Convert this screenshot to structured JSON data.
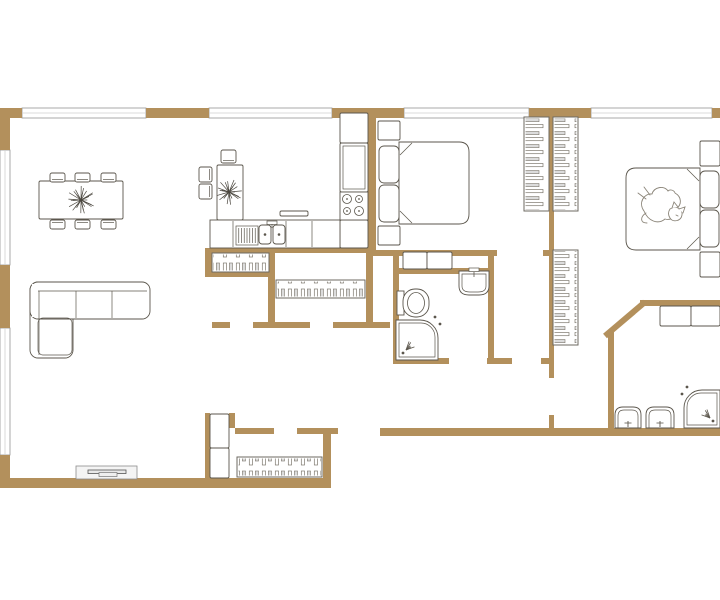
{
  "meta": {
    "description": "apartment floor plan, top view, no text labels"
  },
  "colors": {
    "wall": "#b3905c",
    "outline": "#5b564c",
    "thin": "#8a8a8a",
    "arc": "#c6c6c6",
    "leaf": "#a3a3a3",
    "leafEdge": "#6f6f6f",
    "dark": "#262626",
    "hatchLine": "#7d786e",
    "hatchFill": "#dcdcdc",
    "catLine": "#8a8478",
    "paw": "#8f8f8f",
    "window": "#949494",
    "screenFill": "#e8e8e8"
  },
  "plan": {
    "walls_h": [
      {
        "x1": 0,
        "x2": 22,
        "y": 108,
        "h": 10
      },
      {
        "x1": 146,
        "x2": 209,
        "y": 108,
        "h": 10
      },
      {
        "x1": 332,
        "x2": 404,
        "y": 108,
        "h": 10
      },
      {
        "x1": 529,
        "x2": 591,
        "y": 108,
        "h": 10
      },
      {
        "x1": 712,
        "x2": 720,
        "y": 108,
        "h": 10
      },
      {
        "x1": 372,
        "x2": 497,
        "y": 250,
        "h": 6
      },
      {
        "x1": 543,
        "x2": 554,
        "y": 250,
        "h": 6
      },
      {
        "x1": 205,
        "x2": 372,
        "y": 248,
        "h": 5
      },
      {
        "x1": 205,
        "x2": 275,
        "y": 272,
        "h": 5
      },
      {
        "x1": 212,
        "x2": 230,
        "y": 322,
        "h": 6
      },
      {
        "x1": 253,
        "x2": 310,
        "y": 322,
        "h": 6
      },
      {
        "x1": 333,
        "x2": 390,
        "y": 322,
        "h": 6
      },
      {
        "x1": 393,
        "x2": 494,
        "y": 268,
        "h": 6
      },
      {
        "x1": 393,
        "x2": 449,
        "y": 358,
        "h": 6
      },
      {
        "x1": 487,
        "x2": 512,
        "y": 358,
        "h": 6
      },
      {
        "x1": 541,
        "x2": 554,
        "y": 358,
        "h": 6
      },
      {
        "x1": 640,
        "x2": 720,
        "y": 300,
        "h": 6
      },
      {
        "x1": 235,
        "x2": 274,
        "y": 428,
        "h": 6
      },
      {
        "x1": 297,
        "x2": 338,
        "y": 428,
        "h": 6
      },
      {
        "x1": 380,
        "x2": 720,
        "y": 428,
        "h": 8
      },
      {
        "x1": 0,
        "x2": 331,
        "y": 478,
        "h": 10
      }
    ],
    "walls_v": [
      {
        "x": 0,
        "y1": 108,
        "y2": 150,
        "w": 10
      },
      {
        "x": 0,
        "y1": 265,
        "y2": 328,
        "w": 10
      },
      {
        "x": 0,
        "y1": 455,
        "y2": 488,
        "w": 10
      },
      {
        "x": 368,
        "y1": 118,
        "y2": 254,
        "w": 8
      },
      {
        "x": 366,
        "y1": 248,
        "y2": 328,
        "w": 7
      },
      {
        "x": 549,
        "y1": 118,
        "y2": 378,
        "w": 5
      },
      {
        "x": 549,
        "y1": 415,
        "y2": 428,
        "w": 5
      },
      {
        "x": 608,
        "y1": 332,
        "y2": 428,
        "w": 6
      },
      {
        "x": 205,
        "y1": 248,
        "y2": 277,
        "w": 7
      },
      {
        "x": 268,
        "y1": 248,
        "y2": 328,
        "w": 7
      },
      {
        "x": 393,
        "y1": 250,
        "y2": 358,
        "w": 6
      },
      {
        "x": 488,
        "y1": 250,
        "y2": 358,
        "w": 6
      },
      {
        "x": 205,
        "y1": 413,
        "y2": 488,
        "w": 5
      },
      {
        "x": 229,
        "y1": 413,
        "y2": 428,
        "w": 6
      },
      {
        "x": 323,
        "y1": 428,
        "y2": 488,
        "w": 8
      }
    ],
    "walls_d": [
      {
        "x1": 605,
        "y1": 336,
        "x2": 645,
        "y2": 302,
        "w": 6
      }
    ],
    "windows": [
      {
        "x": 22,
        "y": 108,
        "w": 124,
        "h": 10,
        "o": "h"
      },
      {
        "x": 209,
        "y": 108,
        "w": 123,
        "h": 10,
        "o": "h"
      },
      {
        "x": 404,
        "y": 108,
        "w": 125,
        "h": 10,
        "o": "h"
      },
      {
        "x": 591,
        "y": 108,
        "w": 121,
        "h": 10,
        "o": "h"
      },
      {
        "x": 0,
        "y": 150,
        "w": 10,
        "h": 115,
        "o": "v"
      },
      {
        "x": 0,
        "y": 328,
        "w": 10,
        "h": 127,
        "o": "v"
      }
    ],
    "wardrobes": [
      {
        "n": "wardrobe-bedroom1",
        "x": 524,
        "y": 117,
        "w": 25,
        "h": 94,
        "o": "v"
      },
      {
        "n": "wardrobe-bedroom2",
        "x": 553,
        "y": 117,
        "w": 25,
        "h": 94,
        "o": "v"
      },
      {
        "n": "wardrobe-bedroom2-lower",
        "x": 553,
        "y": 250,
        "w": 25,
        "h": 95,
        "o": "v"
      },
      {
        "n": "closet-kitchen-left",
        "x": 212,
        "y": 253,
        "w": 57,
        "h": 19,
        "o": "h"
      },
      {
        "n": "closet-kitchen-right",
        "x": 276,
        "y": 280,
        "w": 89,
        "h": 18,
        "o": "h"
      },
      {
        "n": "entry-radiator",
        "x": 237,
        "y": 457,
        "w": 85,
        "h": 20,
        "o": "h"
      }
    ],
    "cabinets": [
      {
        "n": "kitchen-tall-cabinet",
        "x": 340,
        "y": 113,
        "w": 28,
        "h": 30
      },
      {
        "n": "kitchen-cabinet",
        "x": 340,
        "y": 143,
        "w": 28,
        "h": 49,
        "inner": true
      },
      {
        "n": "kitchen-counter-end",
        "x": 340,
        "y": 220,
        "w": 28,
        "h": 28
      },
      {
        "n": "kitchen-shelf",
        "x": 280,
        "y": 211,
        "w": 28,
        "h": 5
      },
      {
        "n": "laundry-cabinet",
        "x": 403,
        "y": 252,
        "w": 24,
        "h": 17
      },
      {
        "n": "laundry-cabinet",
        "x": 427,
        "y": 252,
        "w": 25,
        "h": 17
      },
      {
        "n": "bath-counter",
        "x": 660,
        "y": 306,
        "w": 31,
        "h": 20
      },
      {
        "n": "bath-counter",
        "x": 691,
        "y": 306,
        "w": 29,
        "h": 20
      },
      {
        "n": "entry-cabinet",
        "x": 210,
        "y": 414,
        "w": 19,
        "h": 34
      },
      {
        "n": "entry-cabinet",
        "x": 210,
        "y": 448,
        "w": 19,
        "h": 30
      },
      {
        "n": "nightstand",
        "x": 378,
        "y": 121,
        "w": 22,
        "h": 19
      },
      {
        "n": "nightstand",
        "x": 378,
        "y": 226,
        "w": 22,
        "h": 19
      },
      {
        "n": "nightstand",
        "x": 700,
        "y": 141,
        "w": 20,
        "h": 25
      },
      {
        "n": "nightstand",
        "x": 700,
        "y": 252,
        "w": 20,
        "h": 25
      },
      {
        "n": "dining-table",
        "x": 39,
        "y": 181,
        "w": 84,
        "h": 38
      },
      {
        "n": "bistro-table",
        "x": 217,
        "y": 165,
        "w": 26,
        "h": 55
      }
    ],
    "counter": {
      "x": 210,
      "y": 220,
      "w": 130,
      "h": 28,
      "dividers": [
        233,
        286,
        312
      ]
    },
    "dishrack": {
      "x": 236,
      "y": 226,
      "w": 22,
      "h": 19,
      "lines": 7
    },
    "kitchen_sink": {
      "x": 259,
      "y": 225,
      "bw": 12,
      "bh": 19,
      "gap": 2
    },
    "stove": {
      "x": 340,
      "y": 192,
      "w": 28,
      "h": 28
    },
    "chairs": [
      {
        "n": "dining-chair",
        "x": 50,
        "y": 173,
        "w": 15,
        "h": 9,
        "s": "up"
      },
      {
        "n": "dining-chair",
        "x": 75,
        "y": 173,
        "w": 15,
        "h": 9,
        "s": "up"
      },
      {
        "n": "dining-chair",
        "x": 101,
        "y": 173,
        "w": 15,
        "h": 9,
        "s": "up"
      },
      {
        "n": "dining-chair",
        "x": 50,
        "y": 220,
        "w": 15,
        "h": 9,
        "s": "down"
      },
      {
        "n": "dining-chair",
        "x": 75,
        "y": 220,
        "w": 15,
        "h": 9,
        "s": "down"
      },
      {
        "n": "dining-chair",
        "x": 101,
        "y": 220,
        "w": 15,
        "h": 9,
        "s": "down"
      },
      {
        "n": "bistro-chair",
        "x": 199,
        "y": 167,
        "w": 13,
        "h": 15,
        "s": "left"
      },
      {
        "n": "bistro-chair",
        "x": 199,
        "y": 184,
        "w": 13,
        "h": 15,
        "s": "left"
      },
      {
        "n": "bistro-chair",
        "x": 221,
        "y": 150,
        "w": 15,
        "h": 13,
        "s": "up"
      }
    ],
    "plants": [
      {
        "n": "plant-dining",
        "cx": 81,
        "cy": 200,
        "r": 14,
        "spokes": 26
      },
      {
        "n": "plant-bistro",
        "cx": 229,
        "cy": 192,
        "r": 13,
        "spokes": 24
      }
    ],
    "sofa": {
      "x": 30,
      "y": 282,
      "wide": 120,
      "deep": 37,
      "chaiseW": 43,
      "chaiseH": 76
    },
    "tv": {
      "x": 76,
      "y": 466,
      "w": 61,
      "h": 13
    },
    "beds": [
      {
        "n": "bed-bedroom1",
        "x": 399,
        "y": 142,
        "w": 70,
        "h": 82,
        "side": "left",
        "pillows": [
          [
            379,
            146,
            20,
            37
          ],
          [
            379,
            185,
            20,
            37
          ]
        ]
      },
      {
        "n": "bed-bedroom2",
        "x": 626,
        "y": 168,
        "w": 74,
        "h": 82,
        "side": "right",
        "pillows": [
          [
            700,
            171,
            19,
            37
          ],
          [
            700,
            210,
            19,
            37
          ]
        ]
      }
    ],
    "cat": {
      "cx": 660,
      "cy": 207
    },
    "toilet": {
      "x": 397,
      "y": 289,
      "w": 32,
      "h": 28
    },
    "sinks": [
      {
        "n": "bathroom1-sink",
        "x": 459,
        "y": 271,
        "w": 30,
        "h": 24,
        "dir": "down"
      },
      {
        "n": "bathroom2-sink",
        "x": 615,
        "y": 407,
        "w": 26,
        "h": 21,
        "dir": "up"
      },
      {
        "n": "bathroom2-sink",
        "x": 646,
        "y": 407,
        "w": 28,
        "h": 21,
        "dir": "up"
      }
    ],
    "showers": [
      {
        "n": "shower-bathroom1",
        "x": 396,
        "y": 320,
        "w": 42,
        "h": 40,
        "corner": "ne",
        "sparkle": "sw"
      },
      {
        "n": "shower-bathroom2",
        "x": 684,
        "y": 390,
        "w": 36,
        "h": 38,
        "corner": "nw",
        "sparkle": "se"
      }
    ],
    "bathtub": {
      "x": 692,
      "y": 340,
      "w": 46,
      "h": 24
    },
    "doors": [
      {
        "n": "entry-door",
        "leaf": [
          373,
          388,
          4.5,
          40
        ],
        "arc": "M377,388 A40,40 0 0 0 337,428",
        "marks": [
          [
            335,
            429
          ],
          [
            376,
            429
          ]
        ]
      },
      {
        "n": "bathroom1-door",
        "leaf": [
          483,
          322,
          4,
          37
        ],
        "arc": "M485,322 A37,37 0 0 0 448,359",
        "marks": [
          [
            446,
            358
          ],
          [
            485,
            358
          ]
        ]
      },
      {
        "n": "bedroom1-door",
        "leaf": [
          508,
          327,
          4,
          32
        ],
        "arc": "M510,327 A31,31 0 0 1 541,358",
        "marks": [
          [
            509,
            358
          ],
          [
            540,
            358
          ]
        ]
      },
      {
        "n": "hall-door",
        "leaf": [
          551,
          412,
          37,
          4.5
        ],
        "arc": "M588,414 A37,37 0 0 0 551,377",
        "marks": [
          [
            550,
            376
          ],
          [
            550,
            413
          ]
        ]
      },
      {
        "n": "bathroom2-door",
        "line": [
          640,
          303,
          661,
          325
        ],
        "arc": "M661,325 A30,30 0 0 1 618,324",
        "marks": [
          [
            638,
            301
          ]
        ]
      }
    ],
    "paw_prints": [
      [
        358,
        444,
        20
      ],
      [
        371,
        458,
        -15
      ],
      [
        360,
        475,
        10
      ],
      [
        377,
        471,
        -20
      ],
      [
        386,
        489,
        15
      ],
      [
        379,
        504,
        -5
      ]
    ]
  }
}
